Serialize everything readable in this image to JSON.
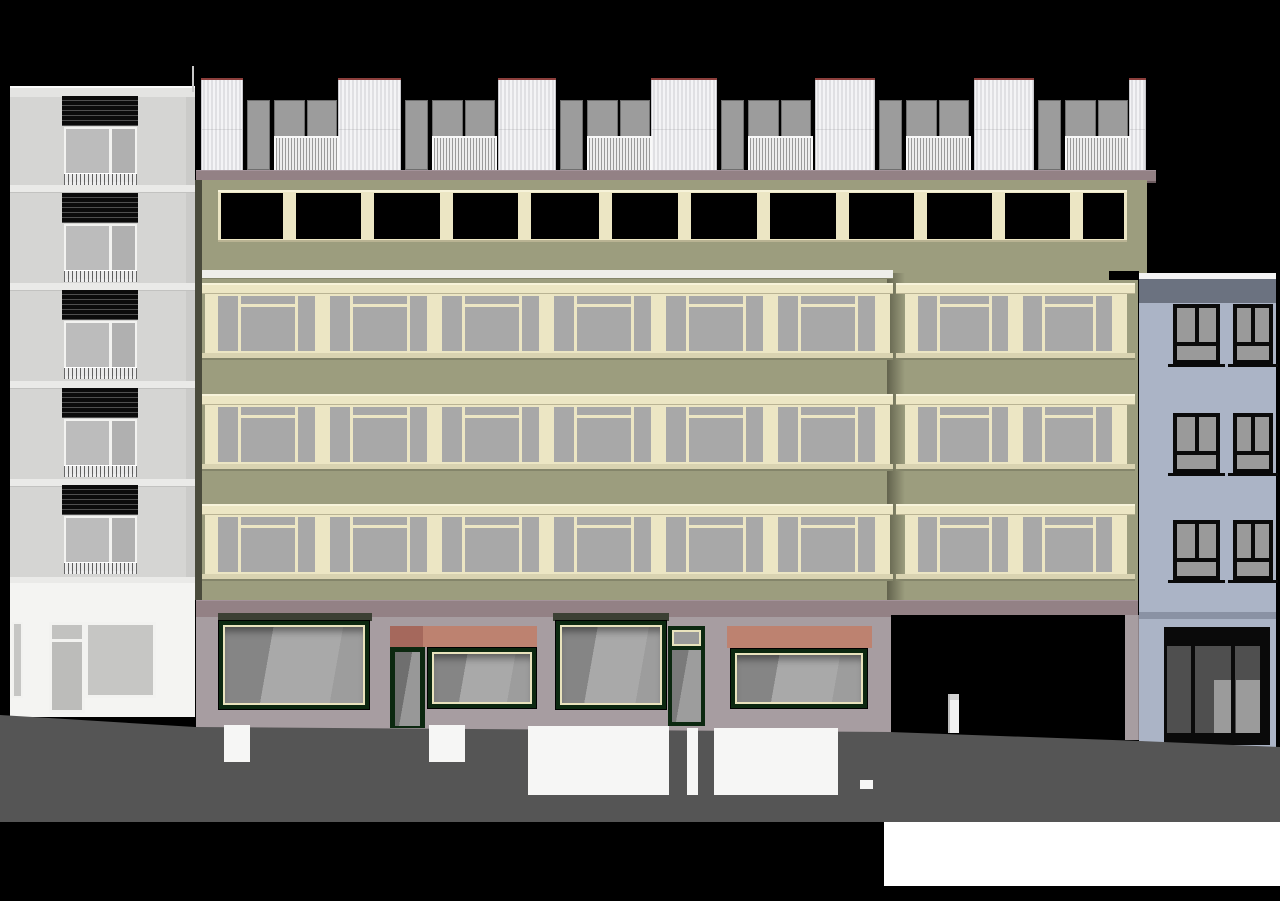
{
  "meta": {
    "kind": "architectural-street-elevation",
    "buildings": [
      "left-residential-building",
      "main-commercial-building",
      "right-blue-building"
    ]
  },
  "scene": {
    "canvas": {
      "w": 1280,
      "h": 901
    },
    "palette": {
      "bg": "#000000",
      "olive": "#9c9d7e",
      "olive_dark": "#84856a",
      "seam_shadow": "#4a4b3c",
      "cream": "#ece6c4",
      "cream_hi": "#f7f3da",
      "cream_lo": "#b9b393",
      "cream_sill": "#d9d3b1",
      "glass_upper": "#a8a8a8",
      "cornice": "#938185",
      "cornice_hi": "#a4939a",
      "cornice_lo": "#6e5d61",
      "base": "#a79da1",
      "base_shadow": "#8c8287",
      "green_frame": "#0c2810",
      "shop_trim": "#e9e3bd",
      "shop_lintel": "#3c4034",
      "awning": "#bd8270",
      "awning_dark": "#a5685c",
      "panel_red": "#8c3f3c",
      "roof_gray": "#9c9c9c",
      "canopy_white": "#eeeeea",
      "left_facade": "#d5d5d3",
      "left_edge": "#c3c3c1",
      "left_slab": "#eaeae8",
      "left_slab_lo": "#c2c2c0",
      "left_parapet": "#e4e4e2",
      "left_parapet_hi": "#fafafa",
      "left_ground": "#f4f4f2",
      "left_glass_a": "#bcbcbc",
      "left_glass_b": "#b0b0b0",
      "left_ground_glass": "#c6c6c4",
      "win_white": "#f2f2f0",
      "blue_facade": "#abb4c6",
      "blue_parapet": "#6b7280",
      "blue_coping": "#f4f4f4",
      "blue_line": "#8a92a4",
      "blue_glass": "#9a9a9a",
      "blue_dark_panel": "#4f4f4f",
      "blue_light_panel": "#9b9b9b",
      "blue_frame": "#0a0a0a",
      "passage_black": "#000000",
      "passage_door": "#f2f2f2",
      "sidewalk": "#555555",
      "patch_white": "#f6f6f5",
      "bottom_strip": "#ffffff",
      "antenna": "#c8c8c8",
      "notch": "#000000"
    },
    "left_building": {
      "x": 10,
      "w": 185,
      "parapet": {
        "y": 86,
        "h": 11
      },
      "facade": {
        "y": 97,
        "h": 486
      },
      "edge_col": {
        "x": 186,
        "w": 9
      },
      "slabs": [
        185,
        283,
        381,
        479,
        577
      ],
      "slab_h": 7,
      "shutter": {
        "x": 62,
        "w": 76,
        "h": 30,
        "ys": [
          96,
          193,
          290,
          388,
          485
        ]
      },
      "window": {
        "x": 64,
        "w": 73,
        "h": 57,
        "ys": [
          127,
          224,
          321,
          419,
          516
        ],
        "rail_h": 11,
        "divider_pos": 0.62
      },
      "ground": {
        "y": 583,
        "h": 134,
        "win_small": {
          "x": 12,
          "y": 622,
          "w": 11,
          "h": 76
        },
        "door": {
          "x": 49,
          "y": 622,
          "w": 36,
          "h": 91,
          "transom_h": 14
        },
        "win_big": {
          "x": 85,
          "y": 622,
          "w": 71,
          "h": 76
        }
      },
      "antenna": {
        "x": 192,
        "y": 66,
        "w": 2,
        "h": 26
      }
    },
    "main_building": {
      "cornice": {
        "x": 196,
        "y": 170,
        "w": 960,
        "h": 10
      },
      "seam_left": {
        "x": 195,
        "y": 180,
        "w": 7,
        "h": 420
      },
      "roof": {
        "white_y": 78,
        "white_h": 92,
        "white": [
          [
            201,
            42
          ],
          [
            338,
            63
          ],
          [
            498,
            58
          ],
          [
            651,
            66
          ],
          [
            815,
            60
          ],
          [
            974,
            60
          ],
          [
            1129,
            17
          ]
        ],
        "solo_y": 100,
        "solo_h": 68,
        "solo": [
          [
            247,
            21
          ],
          [
            405,
            21
          ],
          [
            560,
            21
          ],
          [
            721,
            21
          ],
          [
            879,
            21
          ],
          [
            1038,
            21
          ]
        ],
        "pair_y": 100,
        "pair_h": 36,
        "rail_y": 136,
        "rail_h": 32,
        "pairs": [
          [
            274,
            61
          ],
          [
            432,
            61
          ],
          [
            587,
            61
          ],
          [
            748,
            61
          ],
          [
            906,
            61
          ],
          [
            1065,
            61
          ]
        ]
      },
      "attic": {
        "wall": {
          "x": 202,
          "y": 180,
          "w": 945,
          "h": 93
        },
        "band": {
          "x": 218,
          "y": 190,
          "w": 909,
          "h": 52
        },
        "open_y": 193,
        "open_h": 46,
        "open_x0": 221,
        "open_x1": 1124,
        "piers": [
          283,
          361,
          440,
          518,
          599,
          678,
          757,
          836,
          914,
          992,
          1070
        ],
        "pier_w": 13
      },
      "notch": {
        "x": 1109,
        "y": 271,
        "w": 30,
        "h": 9
      },
      "facade_left": {
        "x": 202,
        "y": 273,
        "w": 691,
        "h": 327
      },
      "facade_right": {
        "x": 893,
        "y": 273,
        "w": 245,
        "h": 327
      },
      "seam_grad": {
        "x": 887,
        "y": 273,
        "w": 18,
        "h": 327
      },
      "canopy": {
        "x": 202,
        "y": 270,
        "w": 691,
        "h": 8
      },
      "rows": {
        "head_ys": [
          283,
          394,
          504
        ],
        "head_h": 11,
        "glass_ys": [
          294,
          405,
          515
        ],
        "glass_h": 59,
        "sill_h": 5,
        "left_frame": {
          "x": 205,
          "w": 685,
          "band_x": 202,
          "band_w": 691,
          "modules": 6
        },
        "right_frame": {
          "x": 905,
          "w": 222,
          "band_x": 896,
          "band_w": 239,
          "modules": 2
        },
        "edge_l": 13,
        "edge_r": 15,
        "pier_w": 15,
        "narrow1": 0.21,
        "narrow2": 0.18,
        "mullion": 3,
        "transom_top": 8,
        "transom_bar": 3
      },
      "ground": {
        "band": {
          "x": 196,
          "y": 600,
          "w": 942,
          "h": 17
        },
        "base": {
          "x": 196,
          "y": 617,
          "w": 695,
          "h": 116
        },
        "lintels": [
          [
            218,
            613,
            154,
            8
          ],
          [
            553,
            613,
            116,
            8
          ]
        ],
        "awning_split": {
          "x": 390,
          "y": 626,
          "w": 147,
          "h": 21,
          "dark_w": 33
        },
        "awning2": {
          "x": 727,
          "y": 626,
          "w": 145,
          "h": 22
        },
        "windows": [
          [
            218,
            620,
            152,
            90
          ],
          [
            427,
            647,
            110,
            62
          ],
          [
            555,
            620,
            112,
            90
          ],
          [
            730,
            648,
            138,
            61
          ]
        ],
        "door1": {
          "x": 390,
          "y": 647,
          "w": 35,
          "h": 81
        },
        "doorwin": {
          "x": 668,
          "y": 626,
          "w": 37,
          "h": 100,
          "transom_h": 22
        },
        "passage": {
          "x": 891,
          "y": 615,
          "w": 234,
          "h": 130
        },
        "passage_door": {
          "x": 948,
          "y": 694,
          "w": 9,
          "h": 39
        },
        "right_pier": {
          "x": 1125,
          "y": 615,
          "w": 13,
          "h": 125
        }
      }
    },
    "blue_building": {
      "x": 1139,
      "w": 137,
      "coping": {
        "y": 273,
        "h": 6
      },
      "parapet": {
        "y": 279,
        "h": 24
      },
      "facade": {
        "y": 303,
        "h": 447
      },
      "ground_line": {
        "y": 612,
        "h": 7
      },
      "windows": {
        "cols": [
          [
            1173,
            47
          ],
          [
            1233,
            40
          ]
        ],
        "rows": [
          304,
          413,
          520
        ],
        "h": 60,
        "frame": 4,
        "transom": 0.66
      },
      "storefront": {
        "x": 1164,
        "y": 627,
        "w": 106,
        "h": 118,
        "lintel_h": 19,
        "dark_panels": [
          [
            1167,
            646,
            24,
            87
          ],
          [
            1195,
            646,
            36,
            87
          ],
          [
            1235,
            646,
            25,
            87
          ]
        ],
        "light_panels": [
          [
            1214,
            680,
            17,
            53
          ],
          [
            1236,
            680,
            24,
            53
          ]
        ]
      }
    },
    "ground": {
      "sidewalk": {
        "x": 0,
        "y": 700,
        "w": 1280,
        "h": 122,
        "poly": [
          [
            0,
            15
          ],
          [
            195,
            27
          ],
          [
            890,
            32
          ],
          [
            1140,
            41
          ],
          [
            1280,
            47
          ],
          [
            1280,
            122
          ],
          [
            0,
            122
          ]
        ]
      },
      "patches": [
        [
          224,
          725,
          26,
          37
        ],
        [
          429,
          725,
          36,
          37
        ],
        [
          528,
          726,
          141,
          69
        ],
        [
          687,
          728,
          11,
          67
        ],
        [
          714,
          728,
          124,
          67
        ],
        [
          860,
          780,
          13,
          9
        ]
      ],
      "white_strip": {
        "x": 884,
        "y": 822,
        "w": 396,
        "h": 64
      }
    }
  }
}
